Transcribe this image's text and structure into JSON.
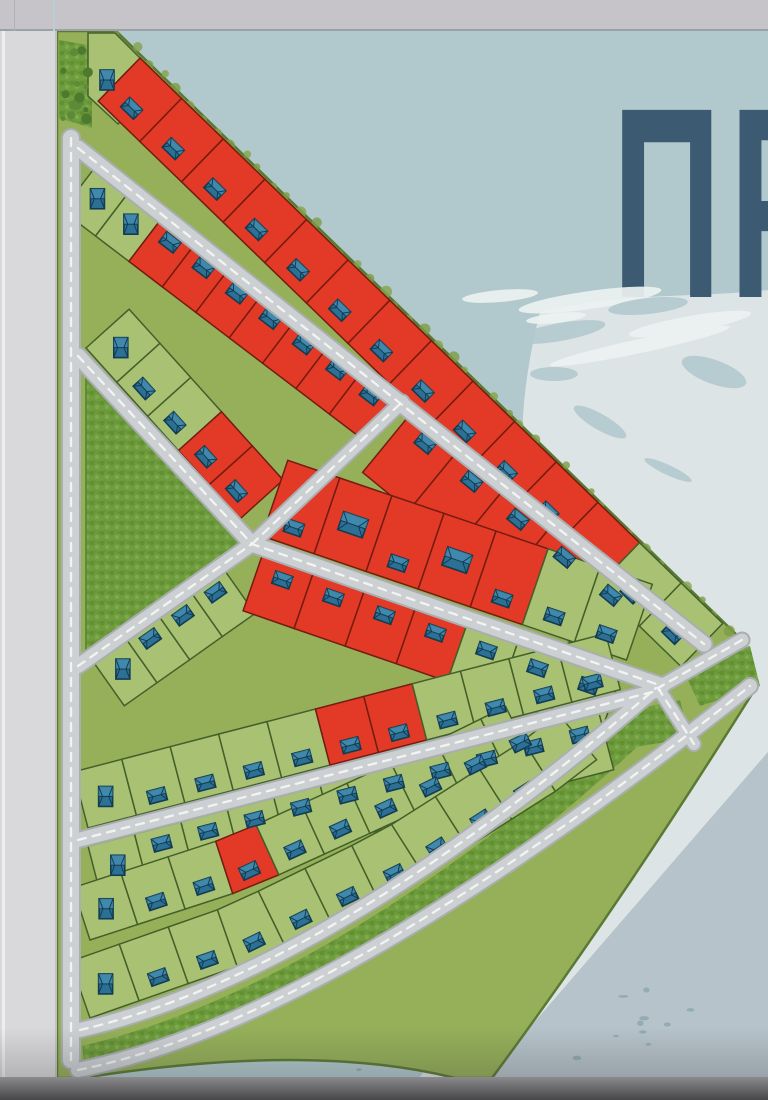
{
  "headline": {
    "text_visible": "ПР"
  },
  "map": {
    "description_semantic": "land-development-master-plan",
    "legend_colors": {
      "sold_lot": "#e23a26",
      "available_lot": "#a9c173"
    },
    "stats": {
      "lots_total": 96,
      "lots_red": 40,
      "lots_green": 56,
      "houses_shown": 96
    },
    "rows": [
      {
        "id": "A",
        "lots": [
          "G",
          "R",
          "R",
          "R",
          "R",
          "R",
          "R",
          "R",
          "R",
          "R",
          "R",
          "R",
          "R",
          "G",
          "G"
        ]
      },
      {
        "id": "B",
        "lots": [
          "G",
          "G",
          "R",
          "R",
          "R",
          "R",
          "R",
          "R",
          "R",
          "R"
        ]
      },
      {
        "id": "C",
        "lots": [
          "G",
          "G",
          "G",
          "R",
          "R"
        ]
      },
      {
        "id": "D",
        "lots": [
          "R",
          "R",
          "R",
          "R",
          "G"
        ]
      },
      {
        "id": "E",
        "lots": [
          "R",
          "R",
          "R",
          "R",
          "R",
          "G",
          "G"
        ]
      },
      {
        "id": "F1",
        "lots": [
          "G",
          "G",
          "G",
          "G"
        ]
      },
      {
        "id": "F2",
        "lots": [
          "R",
          "R",
          "R",
          "R",
          "G",
          "G",
          "G"
        ]
      },
      {
        "id": "G",
        "lots": [
          "G",
          "G",
          "G",
          "G",
          "G",
          "R",
          "R",
          "G",
          "G",
          "G",
          "G"
        ]
      },
      {
        "id": "H",
        "lots": [
          "G",
          "G",
          "G",
          "G",
          "G",
          "G",
          "G",
          "R",
          "R",
          "G",
          "G"
        ]
      },
      {
        "id": "I2",
        "lots": [
          "G",
          "G",
          "G",
          "R",
          "G",
          "G",
          "G",
          "G",
          "G",
          "G"
        ]
      },
      {
        "id": "I",
        "lots": [
          "G",
          "G",
          "G",
          "G",
          "G",
          "G",
          "G",
          "G",
          "G",
          "G",
          "G"
        ]
      }
    ],
    "features": [
      "park-triangle",
      "forest-patch-apex",
      "perimeter-road",
      "grass-medians",
      "road-network"
    ]
  },
  "colors": {
    "background": "#b1c9cd",
    "headline": "#3d5a73",
    "bar_top": "#c6c4c8",
    "bar_top_line_a": "#b2b0b4",
    "bar_top_line_b": "#b9cdd6",
    "panel_left": "#d9d9db",
    "bar_bottom_top": "#8a8a8c",
    "bar_bottom_bottom": "#47474a",
    "plan_base": "#95b059",
    "plan_outline": "#5a7a33",
    "lot_green": "#a9c173",
    "lot_green_border": "#44602a",
    "lot_red": "#e23a26",
    "lot_red_border": "#731c10",
    "road": "#ccd0d3",
    "road_edge": "#a9aeb1",
    "road_dash": "#f3f5f5",
    "grass_texture": "#6f9c3e",
    "grass_texture_dark": "#61902f",
    "grass_texture_light": "#7dab4c",
    "house_fill": "#2d7095",
    "house_dark": "#123c52",
    "house_light": "#4c97b8",
    "snow_light": "#dde4e6",
    "slope_medium": "#b6c3ca",
    "speckle": "#8aa5ae",
    "white_stroke": "#ecf1f1"
  }
}
